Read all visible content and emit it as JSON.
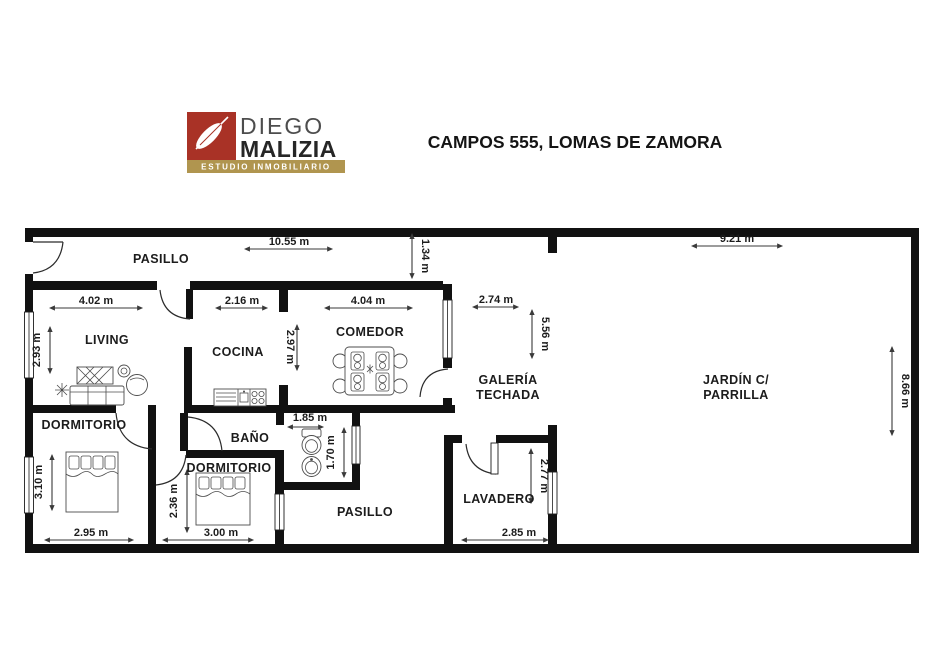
{
  "header": {
    "brand": {
      "name_line1": "DIEGO",
      "name_line2": "MALIZIA",
      "tagline": "ESTUDIO INMOBILIARIO",
      "brand_red": "#a93226",
      "brand_gold": "#b0954f"
    },
    "title": "CAMPOS 555, LOMAS DE ZAMORA"
  },
  "floorplan": {
    "rooms": {
      "pasillo_top": "PASILLO",
      "living": "LIVING",
      "cocina": "COCINA",
      "comedor": "COMEDOR",
      "galeria_line1": "GALERÍA",
      "galeria_line2": "TECHADA",
      "jardin_line1": "JARDÍN C/",
      "jardin_line2": "PARRILLA",
      "dormitorio1": "DORMITORIO",
      "bano": "BAÑO",
      "dormitorio2": "DORMITORIO",
      "pasillo_bottom": "PASILLO",
      "lavadero": "LAVADERO"
    },
    "dimensions": {
      "d1055": "10.55 m",
      "d134": "1.34 m",
      "d921": "9.21 m",
      "d402": "4.02 m",
      "d216": "2.16 m",
      "d404": "4.04 m",
      "d274": "2.74 m",
      "d556": "5.56 m",
      "d293": "2.93 m",
      "d297": "2.97 m",
      "d866": "8.66 m",
      "d310": "3.10 m",
      "d185": "1.85 m",
      "d170": "1.70 m",
      "d236": "2.36 m",
      "d295": "2.95 m",
      "d300": "3.00 m",
      "d285": "2.85 m",
      "d277": "2.77 m"
    },
    "wall_color": "#111111"
  }
}
